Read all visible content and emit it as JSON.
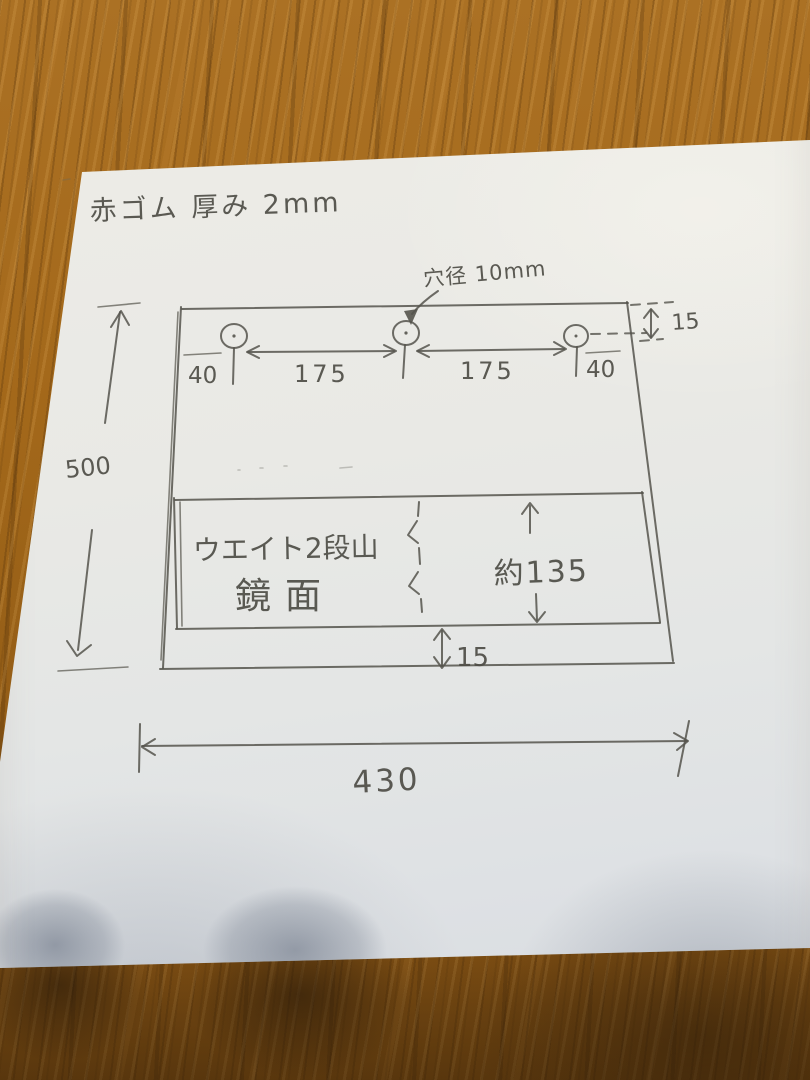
{
  "drawing": {
    "title": "赤ゴム 厚み 2mm",
    "hole_diameter_note": "穴径 10mm",
    "dim_edge_left": "40",
    "dim_hole_spacing_left": "175",
    "dim_hole_spacing_right": "175",
    "dim_edge_right": "40",
    "dim_hole_offset_top": "15",
    "dim_sheet_height": "500",
    "inner_label_line1": "ウエイト2段山",
    "inner_label_line2": "鏡面",
    "dim_inner_height": "約135",
    "dim_strip_gap": "15",
    "dim_sheet_width": "430"
  },
  "colors": {
    "pencil": "#55544c",
    "paper": "#e9e9e5",
    "wood": "#a2691c"
  }
}
